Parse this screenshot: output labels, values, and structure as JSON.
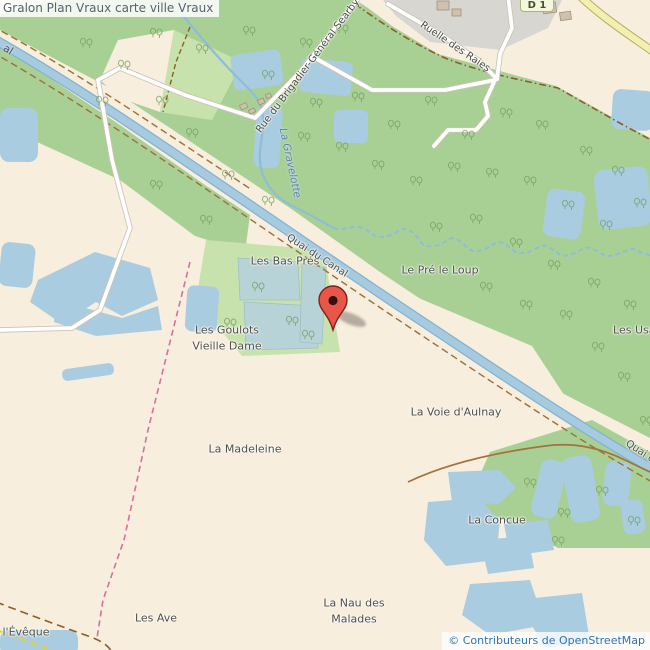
{
  "title": "Gralon Plan Vraux carte ville Vraux",
  "attribution": "© Contributeurs de OpenStreetMap",
  "shield": {
    "text": "D 1"
  },
  "colors": {
    "land": "#f7eedd",
    "forest": "#a8d095",
    "grass": "#c8e2ad",
    "marsh": "#b7d3d8",
    "water": "#a9cce0",
    "canal": "#a6cbe0",
    "residential": "#d8d6d1",
    "road_fill": "#ffffff",
    "road_casing": "#cbc3b4",
    "yellow_road": "#f3efae",
    "towpath_brown": "#9c7037",
    "pink_path": "#d470a2",
    "marker_red": "#e8564a",
    "label_text": "#4e4e46",
    "water_label_blue": "#5c84ad",
    "attribution_blue": "#2d73b5",
    "title_gray": "#56636f"
  },
  "labels": {
    "places": [
      {
        "text": "Les Bas Prés"
      },
      {
        "text": "Le Pré le Loup"
      },
      {
        "text": "Les Goulots"
      },
      {
        "text": "Vieille Dame"
      },
      {
        "text": "Les Usages"
      },
      {
        "text": "La Voie d'Aulnay"
      },
      {
        "text": "La Madeleine"
      },
      {
        "text": "La Concue"
      },
      {
        "text": "La Nau des"
      },
      {
        "text": "Malades"
      },
      {
        "text": "Les Ave"
      },
      {
        "text": "l'Évêque"
      }
    ],
    "roads": [
      {
        "text": "Rue du Brigadier-Général Searby"
      },
      {
        "text": "Ruelle des Raies"
      },
      {
        "text": "Quai du Canal"
      },
      {
        "text": "Quai du Canal"
      }
    ],
    "water": [
      {
        "text": "La Gravelotte"
      },
      {
        "text": "al"
      }
    ]
  }
}
